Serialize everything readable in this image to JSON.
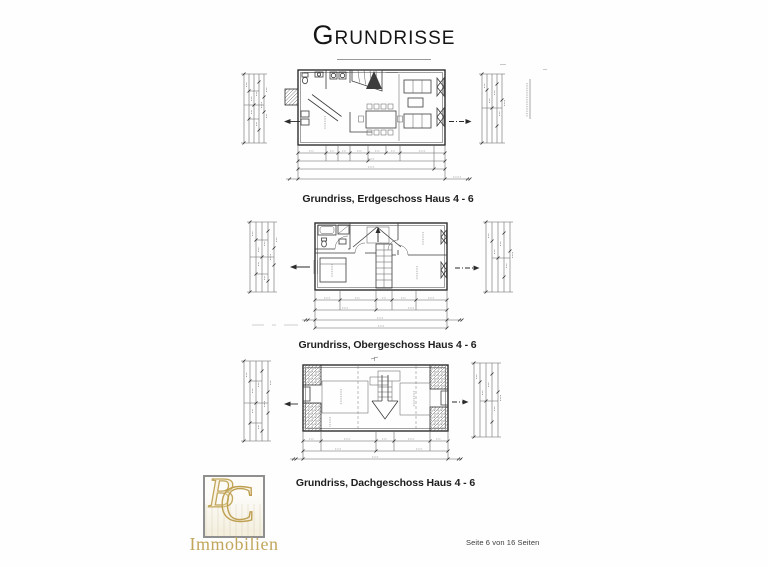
{
  "page": {
    "title": "Grundrisse",
    "footer": "Seite 6 von 16 Seiten"
  },
  "figures": [
    {
      "caption": "Grundriss, Erdgeschoss Haus 4 - 6"
    },
    {
      "caption": "Grundriss, Obergeschoss Haus 4 - 6"
    },
    {
      "caption": "Grundriss, Dachgeschoss Haus 4 - 6"
    }
  ],
  "logo": {
    "monogram": {
      "b": "B",
      "c": "C"
    },
    "name": "Immobilien"
  },
  "colors": {
    "logo_gold": "#c2a65c",
    "ink": "#3d3d3d",
    "paper": "#fefefe"
  }
}
